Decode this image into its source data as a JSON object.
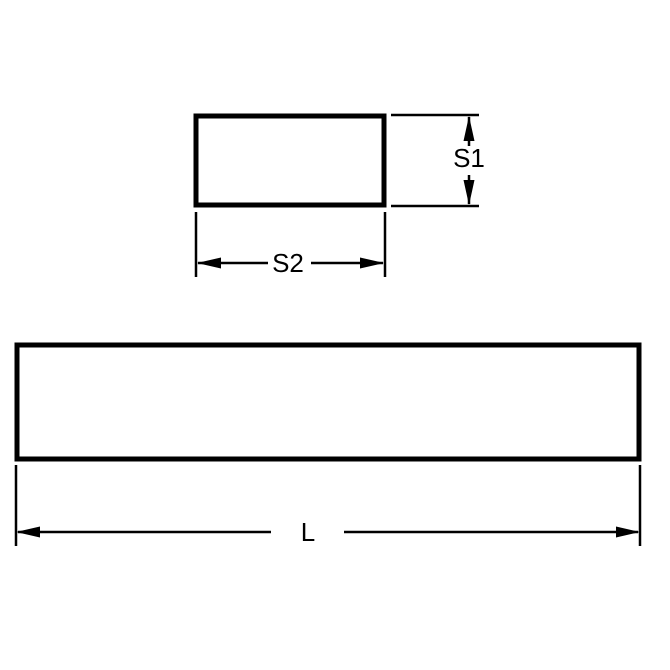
{
  "diagram": {
    "colors": {
      "line": "#000000",
      "background": "#ffffff"
    },
    "labels": {
      "s1": "S1",
      "s2": "S2",
      "l": "L"
    }
  }
}
